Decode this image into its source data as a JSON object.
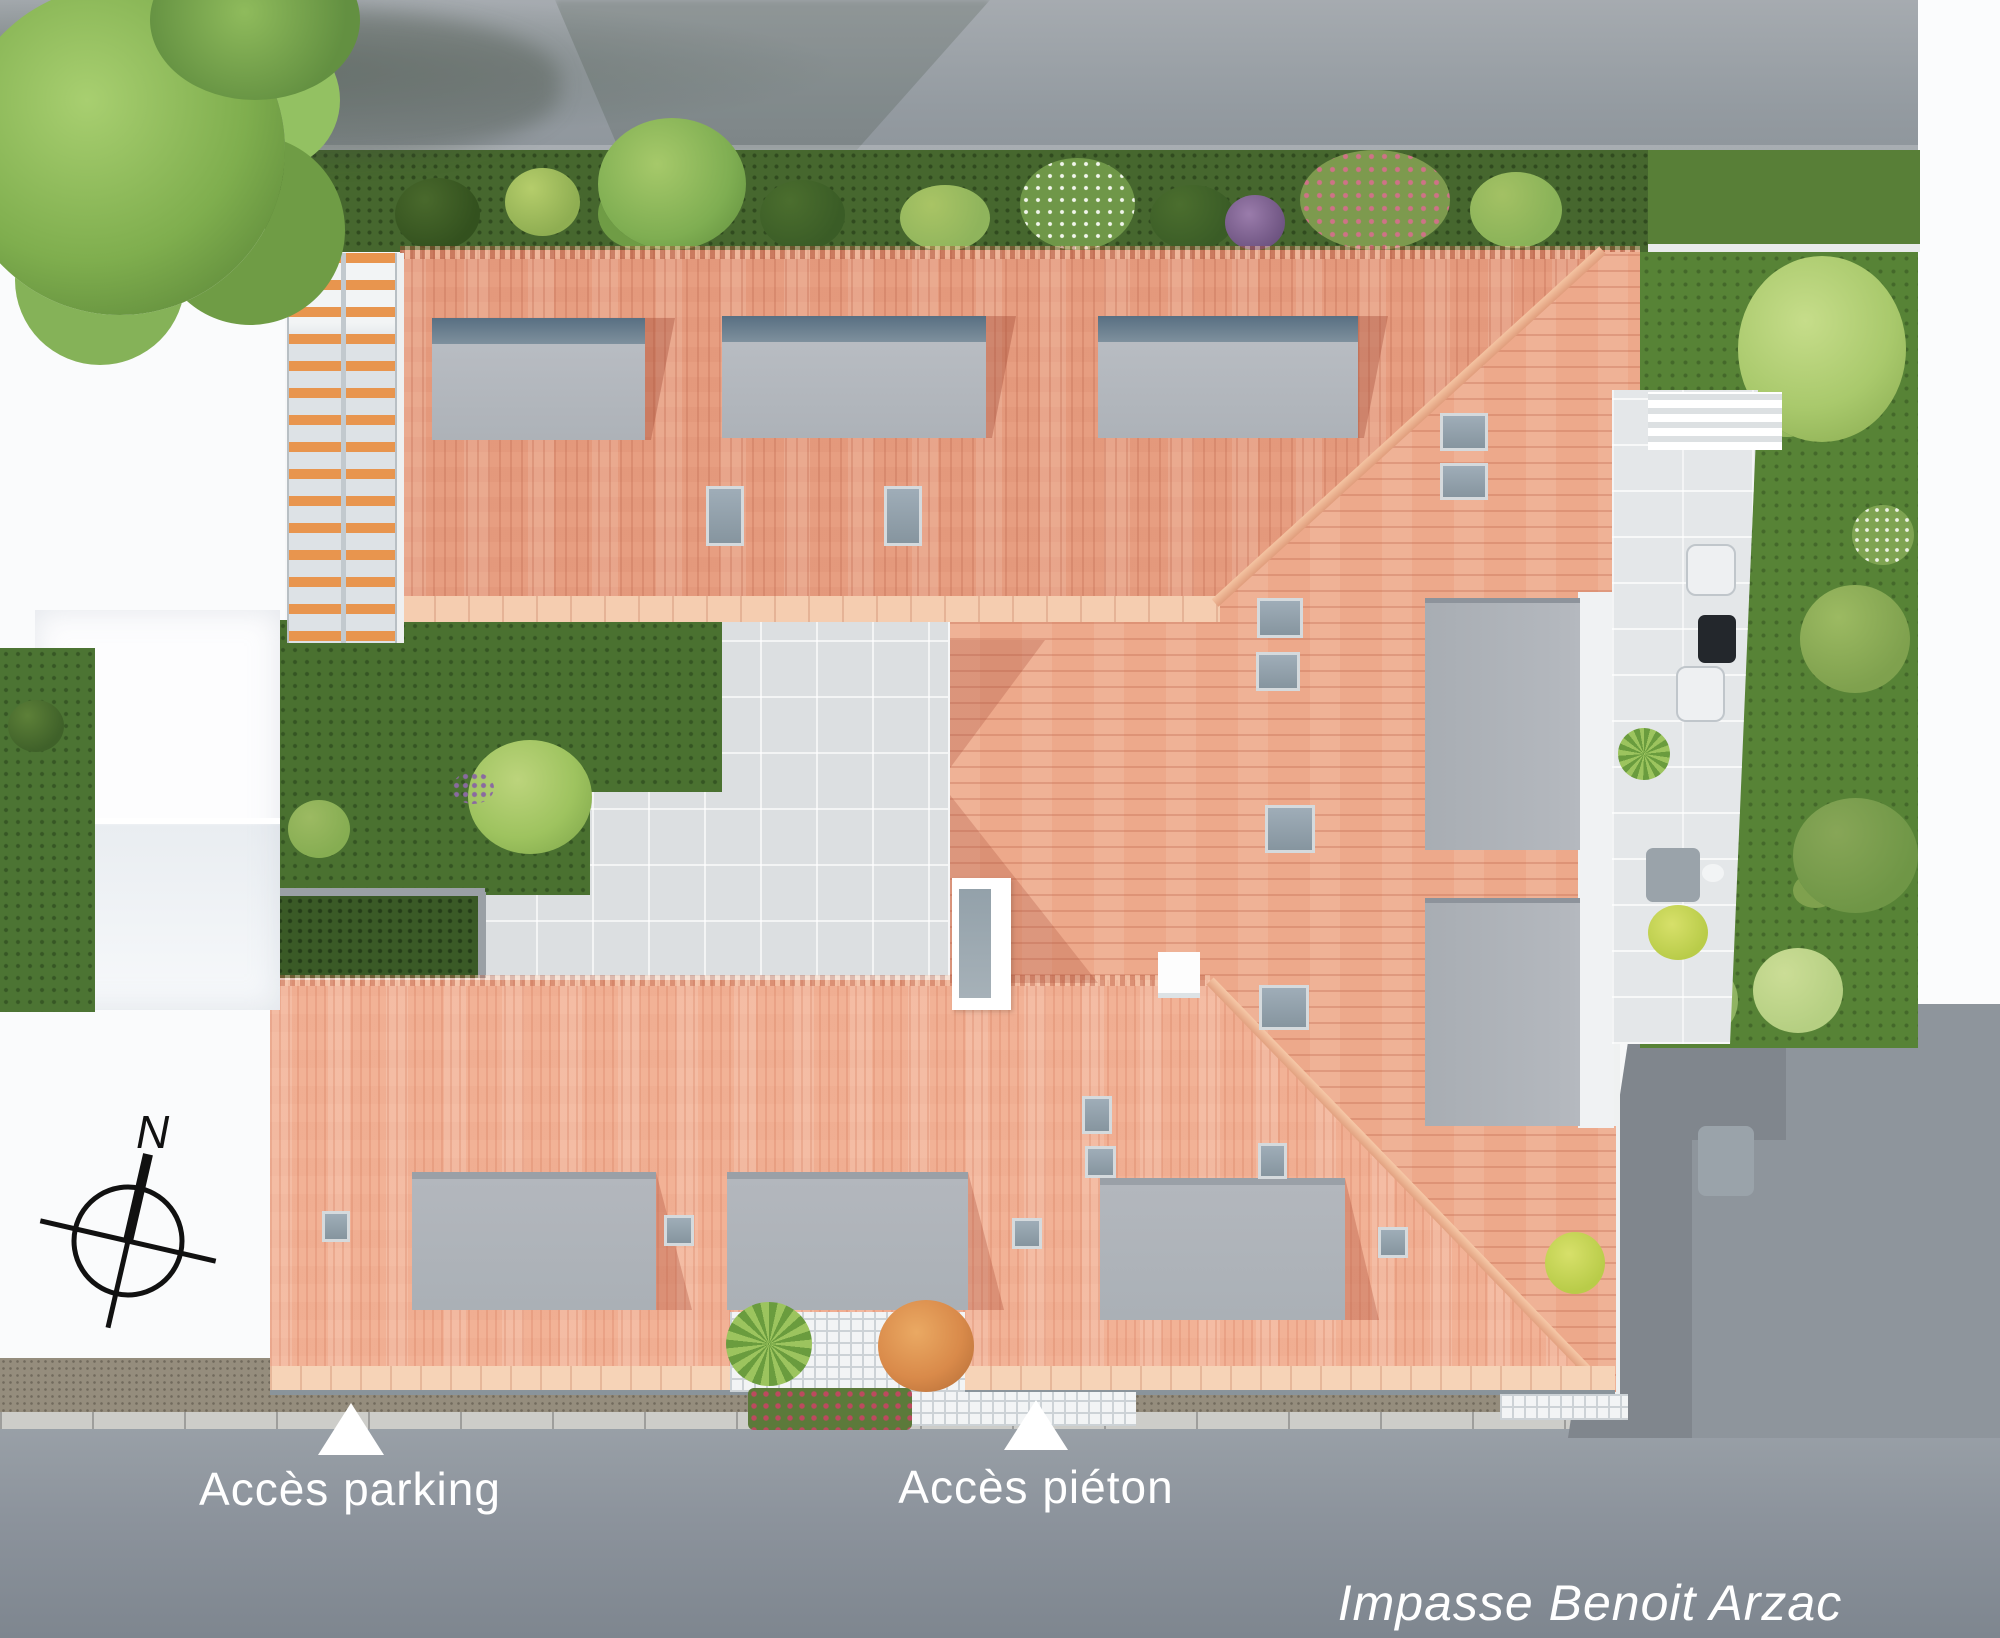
{
  "site_plan": {
    "street_name": "Impasse Benoit Arzac",
    "access_labels": {
      "parking": "Accès parking",
      "pedestrian": "Accès piéton"
    },
    "compass": {
      "north": "N"
    },
    "colors": {
      "roof_tile": "#e79e81",
      "roof_tile_light": "#f2b296",
      "roof_tile_rows": "#eda98b",
      "dormer_gray": "#b4b8be",
      "terrace_gray": "#b1b5bb",
      "lawn_green": "#4a7130",
      "hedge_green": "#46672e",
      "road_gray": "#99a0a7",
      "street_gray": "#8f979f",
      "pavement_gray": "#dcdfe1",
      "label_white": "#ffffff"
    }
  }
}
